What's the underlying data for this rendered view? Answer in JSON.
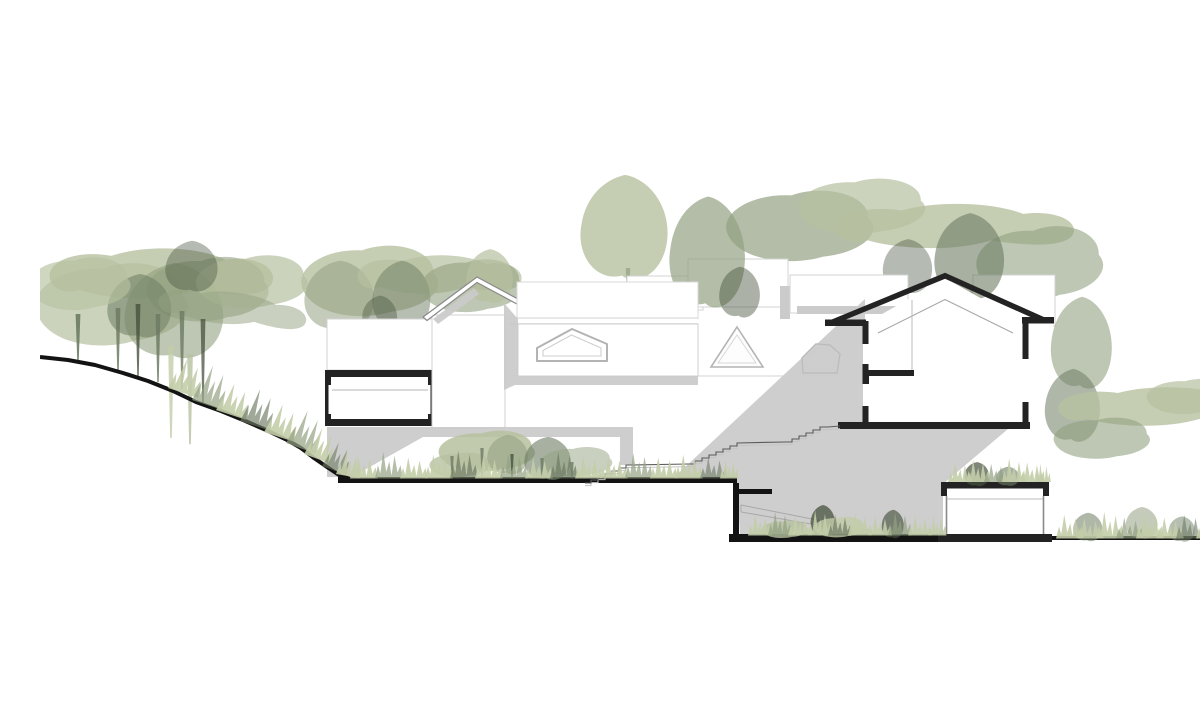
{
  "document": {
    "kind": "sectional-elevation-drawing",
    "label": "Architectural section drawing: terraced buildings on a wooded slope",
    "has_text": false,
    "background": "#ffffff"
  },
  "palette": {
    "c-paper": "#ffffff",
    "c-tree-light": "#b7c1a0",
    "c-tree-mid": "#93a181",
    "c-tree-dark": "#6d7b63",
    "c-tree-deep": "#47523f",
    "c-grass": "#c3cda9",
    "c-shadow": "#cbcbcb",
    "c-outline-light": "#d3d3d3",
    "c-outline-mid": "#a9a9a9",
    "c-section": "#232323",
    "c-ground": "#131313",
    "c-stair-line": "#5a5a5a"
  },
  "scene": {
    "terrain": {
      "left_slope": "descending ground line with grass tufts",
      "upper_terrace": "flat ground under central courtyard",
      "sunken_courtyard": "lower level with planting and ramp",
      "right_terrace": "lower flat ground with grass"
    },
    "buildings": {
      "left_wing": [
        "white elevation volume",
        "cut room with concrete slabs"
      ],
      "gable_house_elevation": "pitched roof outline house",
      "flat_roof_volume": "box with pentagonal skylight window",
      "background_volumes_count": 5,
      "skylight_shapes": [
        "small triangle",
        "large triangle",
        "equilateral triangle",
        "pentagon"
      ],
      "main_cut_house": [
        "pitched roof cut in section",
        "mezzanine slab",
        "floor slab",
        "window gaps in walls"
      ],
      "basement_room": "cut room with green roof fringe"
    },
    "circulation": {
      "terraced_stair_flights": 3,
      "sunken_ramp_lines": 2
    },
    "vegetation": {
      "left_tree_cluster_trunks": 6,
      "canopy_band_top": true,
      "courtyard_shrubs": true,
      "sunken_planting": true,
      "right_bush_with_sapling": true,
      "grass_fringes": true
    },
    "shading": {
      "cast_shadow_diagonal": true,
      "eave_shadows": true
    }
  }
}
